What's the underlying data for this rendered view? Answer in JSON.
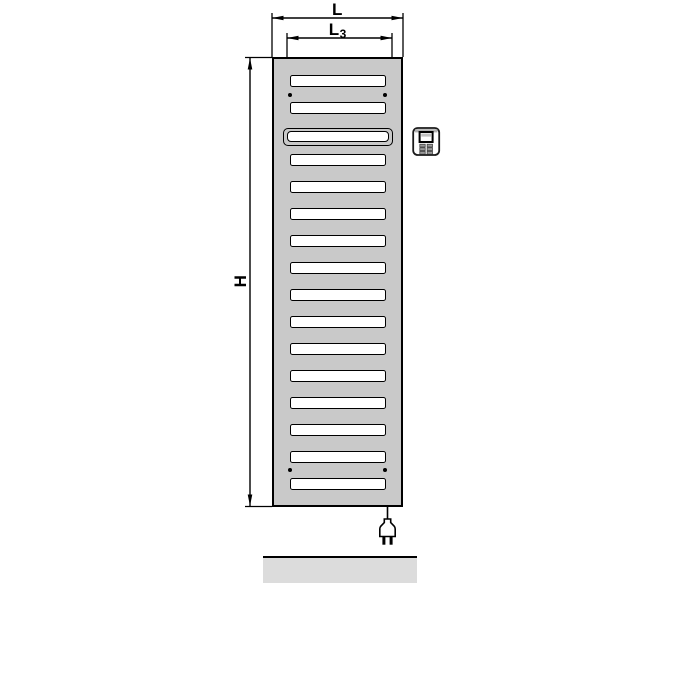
{
  "labels": {
    "width": "L",
    "inner_width_base": "L",
    "inner_width_sub": "3",
    "height": "H"
  },
  "radiator": {
    "body_color": "#c9c9c9",
    "slot_color": "#ffffff",
    "outline_color": "#000000",
    "slot_rows_above_wide": 2,
    "slot_rows_below_wide": 13,
    "total_slot_rows": 16,
    "wide_slot_row_index": 3,
    "mounting_hole_pairs": 2
  },
  "icons": {
    "control_unit": "electronic-control-unit-icon",
    "plug": "power-plug-icon"
  },
  "floor": {
    "color": "#dcdcdc"
  }
}
